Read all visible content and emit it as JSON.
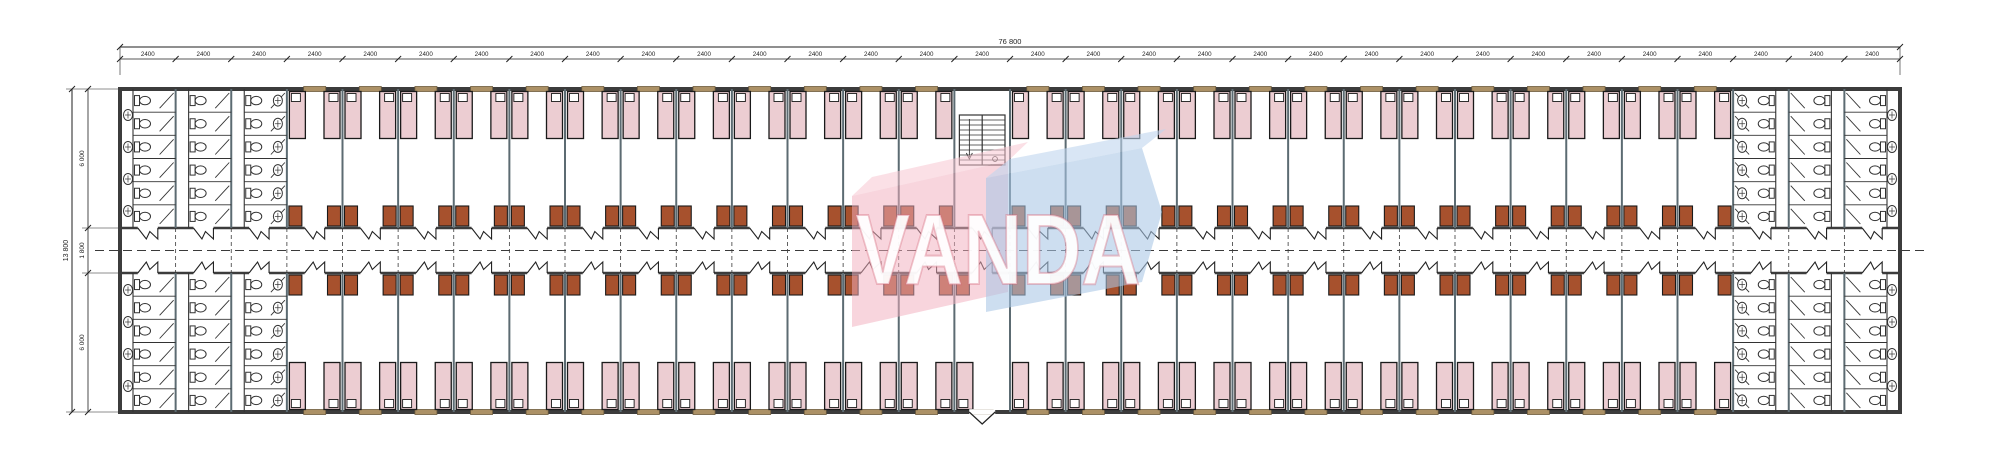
{
  "watermark": {
    "text": "VANDA",
    "pink_color": "#f2aebd",
    "pink_flap_color": "#f7c6d1",
    "blue_color": "#a9c6e6",
    "blue_flap_color": "#c0d5ee",
    "text_color": "#ffffff",
    "text_outline_color": "#d56a7c"
  },
  "dimensions": {
    "top_overall_label": "76 800",
    "top_bay_label": "2400",
    "bay_count": 32,
    "left_overall_label": "13 800",
    "left_segment_labels": [
      "6 000",
      "1 800",
      "6 000"
    ]
  },
  "plan": {
    "room_bay_start": 3,
    "room_bay_end": 28,
    "stair_bay": 15,
    "entrance_bay": 15,
    "sanitary_bays_each_end": 3,
    "stalls_per_column": 6,
    "sink_columns_per_end": 1,
    "sinks_on_end_wall": 4,
    "beds_per_room": 2,
    "rooms_top_row": 25,
    "rooms_bottom_row": 26,
    "icons": [
      "bed",
      "pillow",
      "wardrobe",
      "window",
      "door-swing",
      "wc-icon",
      "sink-icon",
      "stair",
      "entrance-door"
    ],
    "colors": {
      "wall": "#3c3c3c",
      "partition": "#5c6b72",
      "bed_fill": "#eccdd2",
      "bed_stroke": "#1a1a1a",
      "pillow": "#ffffff",
      "wardrobe_fill": "#a7512d",
      "window_fill": "#ac9166",
      "window_stroke": "#6e5c3e",
      "fixture_stroke": "#333333",
      "dashed_line": "#3a3a3a",
      "dimension": "#1f1f1f"
    }
  }
}
